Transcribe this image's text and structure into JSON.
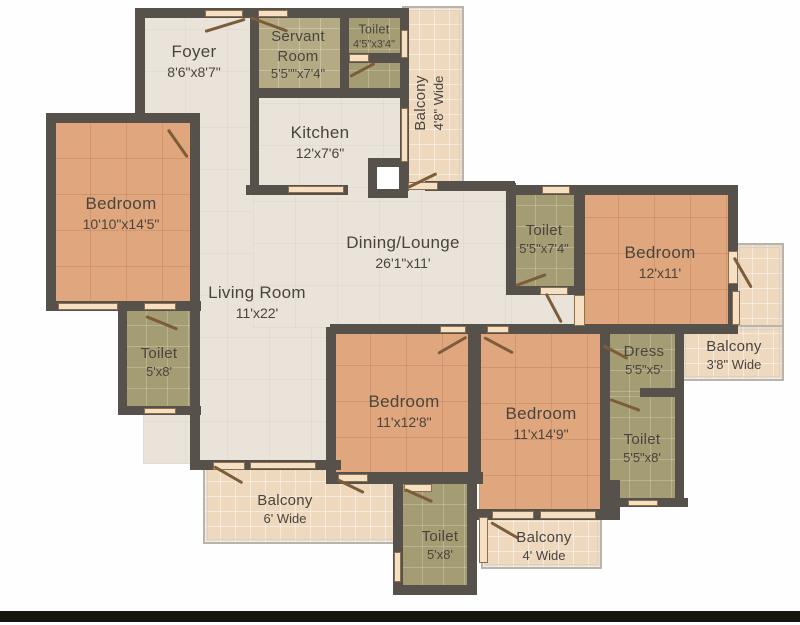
{
  "plan_type": "apartment-floor-plan",
  "colors": {
    "wall": "#57514b",
    "hall_floor": "#e9e3d9",
    "bedroom_floor": "#e0a77e",
    "toilet_floor": "#a49c73",
    "servant_floor": "#b4ab85",
    "balcony_floor": "#eed9bf",
    "balcony_frame": "#b5b4ae",
    "label_text": "#4a443e",
    "footer_bar": "#18140f"
  },
  "rooms": {
    "foyer": {
      "name": "Foyer",
      "dims": "8'6\"x8'7\""
    },
    "servant_room": {
      "name": "Servant Room",
      "dims": "5'5\"\"x7'4\""
    },
    "toilet_top": {
      "name": "Toilet",
      "dims": "4'5\"x3'4\""
    },
    "balcony_top_right": {
      "name": "Balcony",
      "dims": "4'8\" Wide"
    },
    "kitchen": {
      "name": "Kitchen",
      "dims": "12'x7'6\""
    },
    "bedroom_left": {
      "name": "Bedroom",
      "dims": "10'10\"x14'5\""
    },
    "dining_lounge": {
      "name": "Dining/Lounge",
      "dims": "26'1\"x11'"
    },
    "living_room": {
      "name": "Living Room",
      "dims": "11'x22'"
    },
    "toilet_left": {
      "name": "Toilet",
      "dims": "5'x8'"
    },
    "toilet_mid": {
      "name": "Toilet",
      "dims": "5'5\"x7'4\""
    },
    "bedroom_right": {
      "name": "Bedroom",
      "dims": "12'x11'"
    },
    "balcony_right": {
      "name": "Balcony",
      "dims": "3'8\" Wide"
    },
    "dress": {
      "name": "Dress",
      "dims": "5'5\"x5'"
    },
    "toilet_right": {
      "name": "Toilet",
      "dims": "5'5\"x8'"
    },
    "bedroom_bottom_left": {
      "name": "Bedroom",
      "dims": "11'x12'8\""
    },
    "bedroom_bottom_right": {
      "name": "Bedroom",
      "dims": "11'x14'9\""
    },
    "balcony_bottom_left": {
      "name": "Balcony",
      "dims": "6' Wide"
    },
    "toilet_bottom": {
      "name": "Toilet",
      "dims": "5'x8'"
    },
    "balcony_bottom_right": {
      "name": "Balcony",
      "dims": "4' Wide"
    }
  }
}
